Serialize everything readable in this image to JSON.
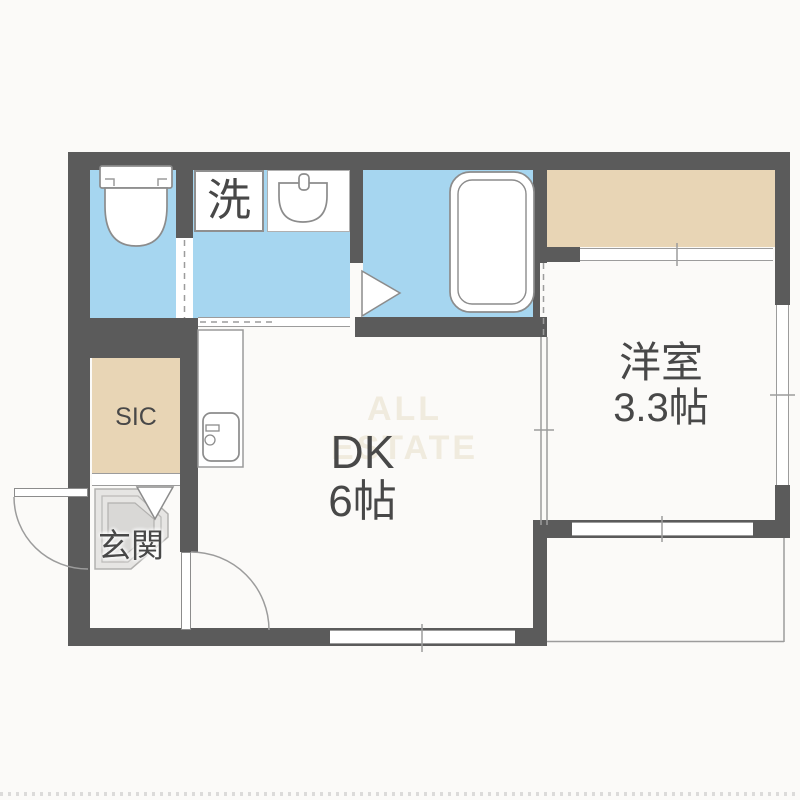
{
  "floorplan": {
    "watermark": "ALL ESTATE",
    "labels": {
      "laundry": "洗",
      "sic": "SIC",
      "entrance": "玄関",
      "dk_name": "DK",
      "dk_size": "6帖",
      "western_name": "洋室",
      "western_size": "3.3帖"
    },
    "colors": {
      "wall": "#5b5b5b",
      "water": "#a6d6f0",
      "storage": "#e8d5b5",
      "tile_light": "#e6e5e3",
      "tile_dark": "#d9d8d6",
      "outline": "#8c8c8c",
      "thin": "#9c9c9c",
      "text": "#484848",
      "watermark": "#f0ebde",
      "background": "#fbfaf8"
    }
  }
}
